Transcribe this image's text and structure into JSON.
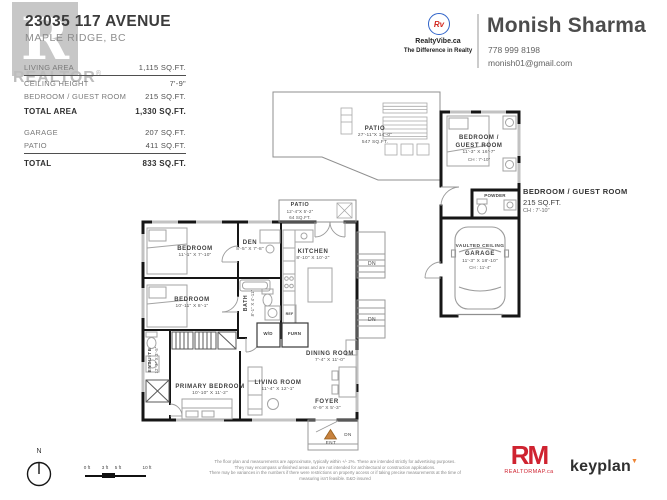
{
  "header": {
    "address_line1": "23035 117 AVENUE",
    "address_line2": "MAPLE RIDGE, BC",
    "watermark_letter": "R",
    "watermark_text": "REALTOR",
    "areas": [
      {
        "label": "LIVING AREA",
        "value": "1,115 SQ.FT."
      },
      {
        "label": "CEILING HEIGHT",
        "value": "7'-9\""
      },
      {
        "label": "BEDROOM / GUEST ROOM",
        "value": "215 SQ.FT."
      },
      {
        "label": "TOTAL AREA",
        "value": "1,330 SQ.FT."
      },
      {
        "label": "GARAGE",
        "value": "207 SQ.FT."
      },
      {
        "label": "PATIO",
        "value": "411 SQ.FT."
      },
      {
        "label": "TOTAL",
        "value": "833 SQ.FT."
      }
    ]
  },
  "agent": {
    "logo_monogram": "Rv",
    "brand": "RealtyVibe.ca",
    "tagline": "The Difference in Realty",
    "name": "Monish Sharma",
    "phone": "778 999 8198",
    "email": "monish01@gmail.com"
  },
  "plan": {
    "patio_upper": {
      "name": "PATIO",
      "dims": "27'-11\"X 14'-0\"",
      "area": "547 SQ.FT."
    },
    "patio_lower": {
      "name": "PATIO",
      "dims": "12'-4\"X 5'-2\"",
      "area": "64 SQ.FT."
    },
    "guest_bedroom": {
      "line1": "BEDROOM /",
      "line2": "GUEST ROOM",
      "dims": "11'-3\"  X  16'-7\"",
      "ch": "CH : 7'-10\""
    },
    "guest_callout": {
      "name": "BEDROOM / GUEST ROOM",
      "area": "215 SQ.FT.",
      "ch": "CH : 7'-10\""
    },
    "powder": {
      "name": "POWDER"
    },
    "garage": {
      "line1": "VAULTED CEILING",
      "line2": "GARAGE",
      "dims": "11'-3\"  X  18'-10\"",
      "ch": "CH : 11'-4\""
    },
    "bedroom1": {
      "name": "BEDROOM",
      "dims": "11'-1\"  X  7'-10\""
    },
    "bedroom2": {
      "name": "BEDROOM",
      "dims": "10'-11\"  X  8'-1\""
    },
    "den": {
      "name": "DEN",
      "dims": "8'-5\"  X  7'-8\""
    },
    "kitchen": {
      "name": "KITCHEN",
      "dims": "8'-10\"  X  10'-2\""
    },
    "bath": {
      "name": "BATH",
      "dims": "8'-1\" X 4'-11\""
    },
    "ensuite": {
      "name": "ENSUITE",
      "dims": "12'-3\" X 3'-5\""
    },
    "primary_bedroom": {
      "name": "PRIMARY BEDROOM",
      "dims": "10'-10\"  X  11'-2\""
    },
    "living_room": {
      "name": "LIVING ROOM",
      "dims": "11'-4\"  X  12'-1\""
    },
    "dining_room": {
      "name": "DINING ROOM",
      "dims": "7'-4\"  X  11'-0\""
    },
    "foyer": {
      "name": "FOYER",
      "dims": "6'-9\"  X  5'-3\""
    },
    "closet_wd": "W/D",
    "closet_furn": "FURN",
    "fridge": "REF",
    "markers": {
      "down1": "DN",
      "down2": "DN",
      "down3": "DN",
      "entry": "ENT",
      "north": "N"
    }
  },
  "footer": {
    "scale_ticks": [
      "0 ft",
      "3 ft",
      "5 ft",
      "10 ft"
    ],
    "disclaimer_line1": "The floor plan and measurements are approximate, typically within +/- 2%. These are intended strictly for advertising purposes.",
    "disclaimer_line2": "They may encompass unfinished areas and are not intended for architectural or construction applications.",
    "disclaimer_line3": "There may be variances in the numbers if there were restrictions on property access or if taking precise measurements at the time of measuring isn't feasible. E&O insured",
    "rm_logo": "RM",
    "rm_sub": "REALTORMAP.ca",
    "keyplan": "keyplan"
  },
  "colors": {
    "wall": "#161616",
    "accent_red": "#cf2330",
    "accent_orange": "#c8823e",
    "watermark_gray": "#c7c7c7"
  }
}
